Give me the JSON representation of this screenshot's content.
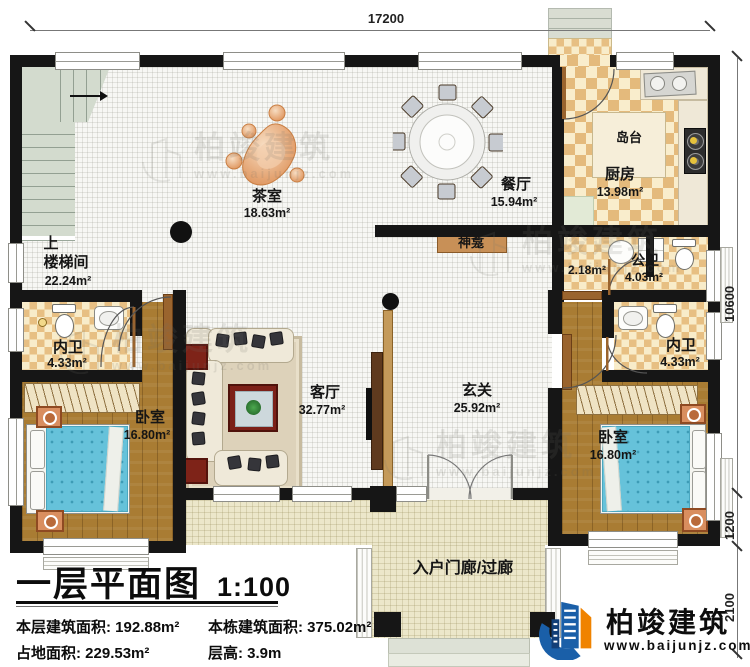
{
  "plan": {
    "title": "一层平面图",
    "scale": "1:100",
    "stats": {
      "floor_area_label": "本层建筑面积:",
      "floor_area_value": "192.88m²",
      "site_area_label": "占地面积:",
      "site_area_value": "229.53m²",
      "building_area_label": "本栋建筑面积:",
      "building_area_value": "375.02m²",
      "storey_height_label": "层高:",
      "storey_height_value": "3.9m"
    }
  },
  "dims": {
    "top_width": "17200",
    "right_height": "10600",
    "right_bay": "1200",
    "right_porch": "2100"
  },
  "rooms": {
    "stair_dir": "上",
    "stair": {
      "name": "楼梯间",
      "area": "22.24m²"
    },
    "tea": {
      "name": "茶室",
      "area": "18.63m²"
    },
    "dining": {
      "name": "餐厅",
      "area": "15.94m²"
    },
    "kitchen": {
      "name": "厨房",
      "area": "13.98m²"
    },
    "island": {
      "name": "岛台"
    },
    "shrine": {
      "name": "神龛"
    },
    "public_bath": {
      "name": "公卫",
      "area": "4.03m²",
      "ante_area": "2.18m²"
    },
    "bath_left": {
      "name": "内卫",
      "area": "4.33m²"
    },
    "bath_right": {
      "name": "内卫",
      "area": "4.33m²"
    },
    "bed_left": {
      "name": "卧室",
      "area": "16.80m²"
    },
    "bed_right": {
      "name": "卧室",
      "area": "16.80m²"
    },
    "living": {
      "name": "客厅",
      "area": "32.77m²"
    },
    "foyer": {
      "name": "玄关",
      "area": "25.92m²"
    },
    "porch": {
      "name": "入户门廊/过廊"
    }
  },
  "brand": {
    "name": "柏竣建筑",
    "website": "www.baijunjz.com"
  },
  "watermark": {
    "name": "柏竣建筑",
    "website": "www.baijunjz.com"
  },
  "colors": {
    "wall": "#161616",
    "checker": "#e4ba7c",
    "wood": "#a97c33",
    "bed": "#66c2da",
    "stair": "#d3dbce",
    "porch": "#ece7ca",
    "shrine": "#c89057",
    "logo_blue": "#1a5fa8",
    "logo_orange": "#f08300"
  }
}
